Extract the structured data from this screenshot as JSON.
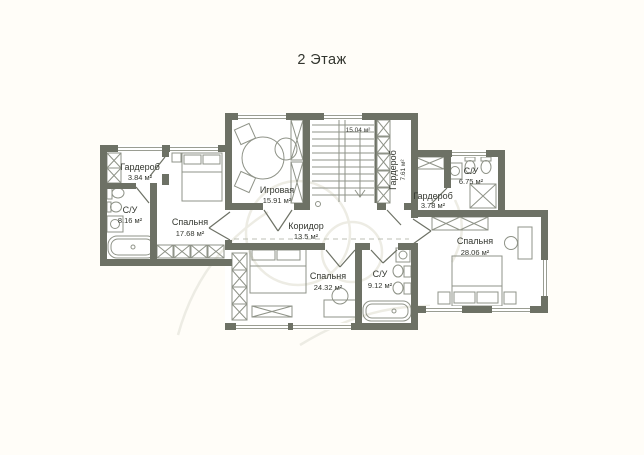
{
  "title": "2 Этаж",
  "rooms": {
    "wardrobe_left": {
      "name": "Гардероб",
      "area": "3.84 м²"
    },
    "bathroom_left": {
      "name": "С/У",
      "area": "8.16 м²"
    },
    "bedroom_left": {
      "name": "Спальня",
      "area": "17.68 м²"
    },
    "playroom": {
      "name": "Игровая",
      "area": "15.91 м²"
    },
    "stairwell": {
      "area": "15.04 м²"
    },
    "wardrobe_stairs": {
      "name": "Гардероб",
      "area": "7.61 м²"
    },
    "corridor": {
      "name": "Коридор",
      "area": "13.5 м²"
    },
    "wardrobe_right": {
      "name": "Гардероб",
      "area": "3.78 м²"
    },
    "bathroom_right": {
      "name": "С/У",
      "area": "6.75 м²"
    },
    "bedroom_right": {
      "name": "Спальня",
      "area": "28.06 м²"
    },
    "bedroom_bottom": {
      "name": "Спальня",
      "area": "24.32 м²"
    },
    "bathroom_bottom": {
      "name": "С/У",
      "area": "9.12 м²"
    }
  },
  "colors": {
    "wall": "#6d7165",
    "furniture_line": "#8f9388",
    "text": "#33362f",
    "background": "#fffdf8",
    "room_fill": "#ffffff",
    "watermark": "#edece4"
  }
}
